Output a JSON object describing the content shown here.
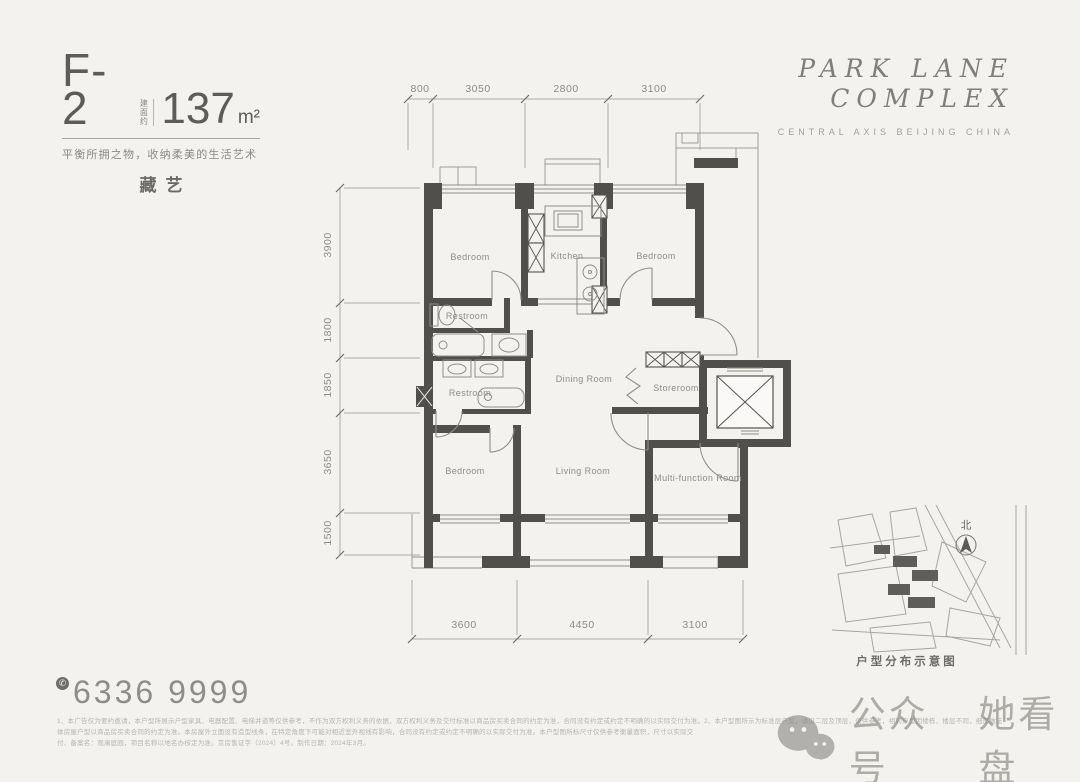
{
  "colors": {
    "background": "#f3f2ef",
    "wall": "#514f4c",
    "thin_line": "#a09e9a",
    "label_text": "#8e8c88",
    "ink": "#5d5c5a",
    "watermark": "#7d7a74"
  },
  "header": {
    "unit_code": "F-2",
    "area_prefix": "建面约",
    "area_value": "137",
    "area_unit": "m²",
    "tagline": "平衡所拥之物，收纳柔美的生活艺术",
    "theme": "藏艺"
  },
  "brand": {
    "line1": "PARK LANE",
    "line2": "COMPLEX",
    "subtitle": "CENTRAL AXIS BEIJING CHINA"
  },
  "plan": {
    "rooms": [
      {
        "label": "Bedroom"
      },
      {
        "label": "Kitchen"
      },
      {
        "label": "Bedroom"
      },
      {
        "label": "Restroom"
      },
      {
        "label": "Restroom"
      },
      {
        "label": "Dining Room"
      },
      {
        "label": "Storeroom"
      },
      {
        "label": "Bedroom"
      },
      {
        "label": "Living Room"
      },
      {
        "label": "Multi-function Room"
      }
    ],
    "dims_top": [
      "800",
      "3050",
      "2800",
      "3100"
    ],
    "dims_left": [
      "3900",
      "1800",
      "1850",
      "3650",
      "1500"
    ],
    "dims_bottom": [
      "3600",
      "4450",
      "3100"
    ]
  },
  "site_map": {
    "north_label": "北",
    "caption": "户型分布示意图"
  },
  "contact": {
    "phone_icon_glyph": "✆",
    "phone_number": "6336 9999"
  },
  "disclaimer": {
    "line1": "1、本广告仅为要约邀请，本户型所展示户型家具、电器配置、电梯井道等仅供参考，不作为双方权利义务的依据，双方权利义务及交付标准以商品房买卖合同的约定为准，合同没有约定或约定不明确的以实际交付为准。2、本户型图所示为标准层户型，详见二层及顶层，仅供参考，相同户型因楼栋、楼层不同，细部做法",
    "line2": "体房屋户型以商品房买卖合同的约定为准。本房屋外立面设有造型线条，在特定角度下可能对相近室外视线有影响，合同没有约定或约定不明确的以实际交付为准。本户型图所标尺寸仅供参考衡量面积，尺寸以实际交",
    "line3": "付、备案名：观澜庭园，项目名称以地名办核定为准。京房售证字（2024）4号。制作日期：2024年3月。"
  },
  "watermark": {
    "prefix": "公众号",
    "name": "她看盘"
  }
}
